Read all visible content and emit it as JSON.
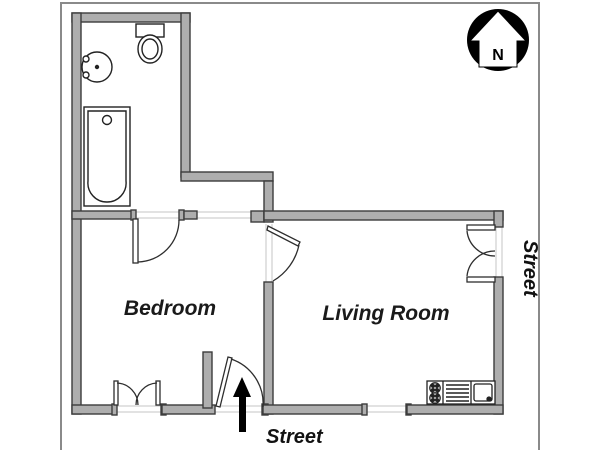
{
  "title": "Apartment Floor Plan",
  "labels": {
    "bedroom": "Bedroom",
    "living_room": "Living Room",
    "street_bottom": "Street",
    "street_right": "Street",
    "north": "N"
  },
  "rooms": [
    {
      "name": "Bathroom",
      "fixtures": [
        "toilet",
        "sink",
        "bathtub"
      ]
    },
    {
      "name": "Bedroom",
      "label_shown": "Bedroom"
    },
    {
      "name": "Living Room",
      "label_shown": "Living Room",
      "fixtures": [
        "stove-two-burners",
        "counter-drainer",
        "kitchen-sink"
      ]
    }
  ],
  "icons": {
    "north_arrow": "compass pointing up with letter N",
    "entrance_arrow": "black arrow pointing up at entrance door"
  },
  "colors": {
    "wall_fill": "#aeaeae",
    "wall_stroke": "#3c3c3c",
    "frame_line": "#8a8a8a",
    "fixture_stroke": "#222222",
    "north_circle": "#000000",
    "text": "#111111",
    "background": "#ffffff"
  }
}
